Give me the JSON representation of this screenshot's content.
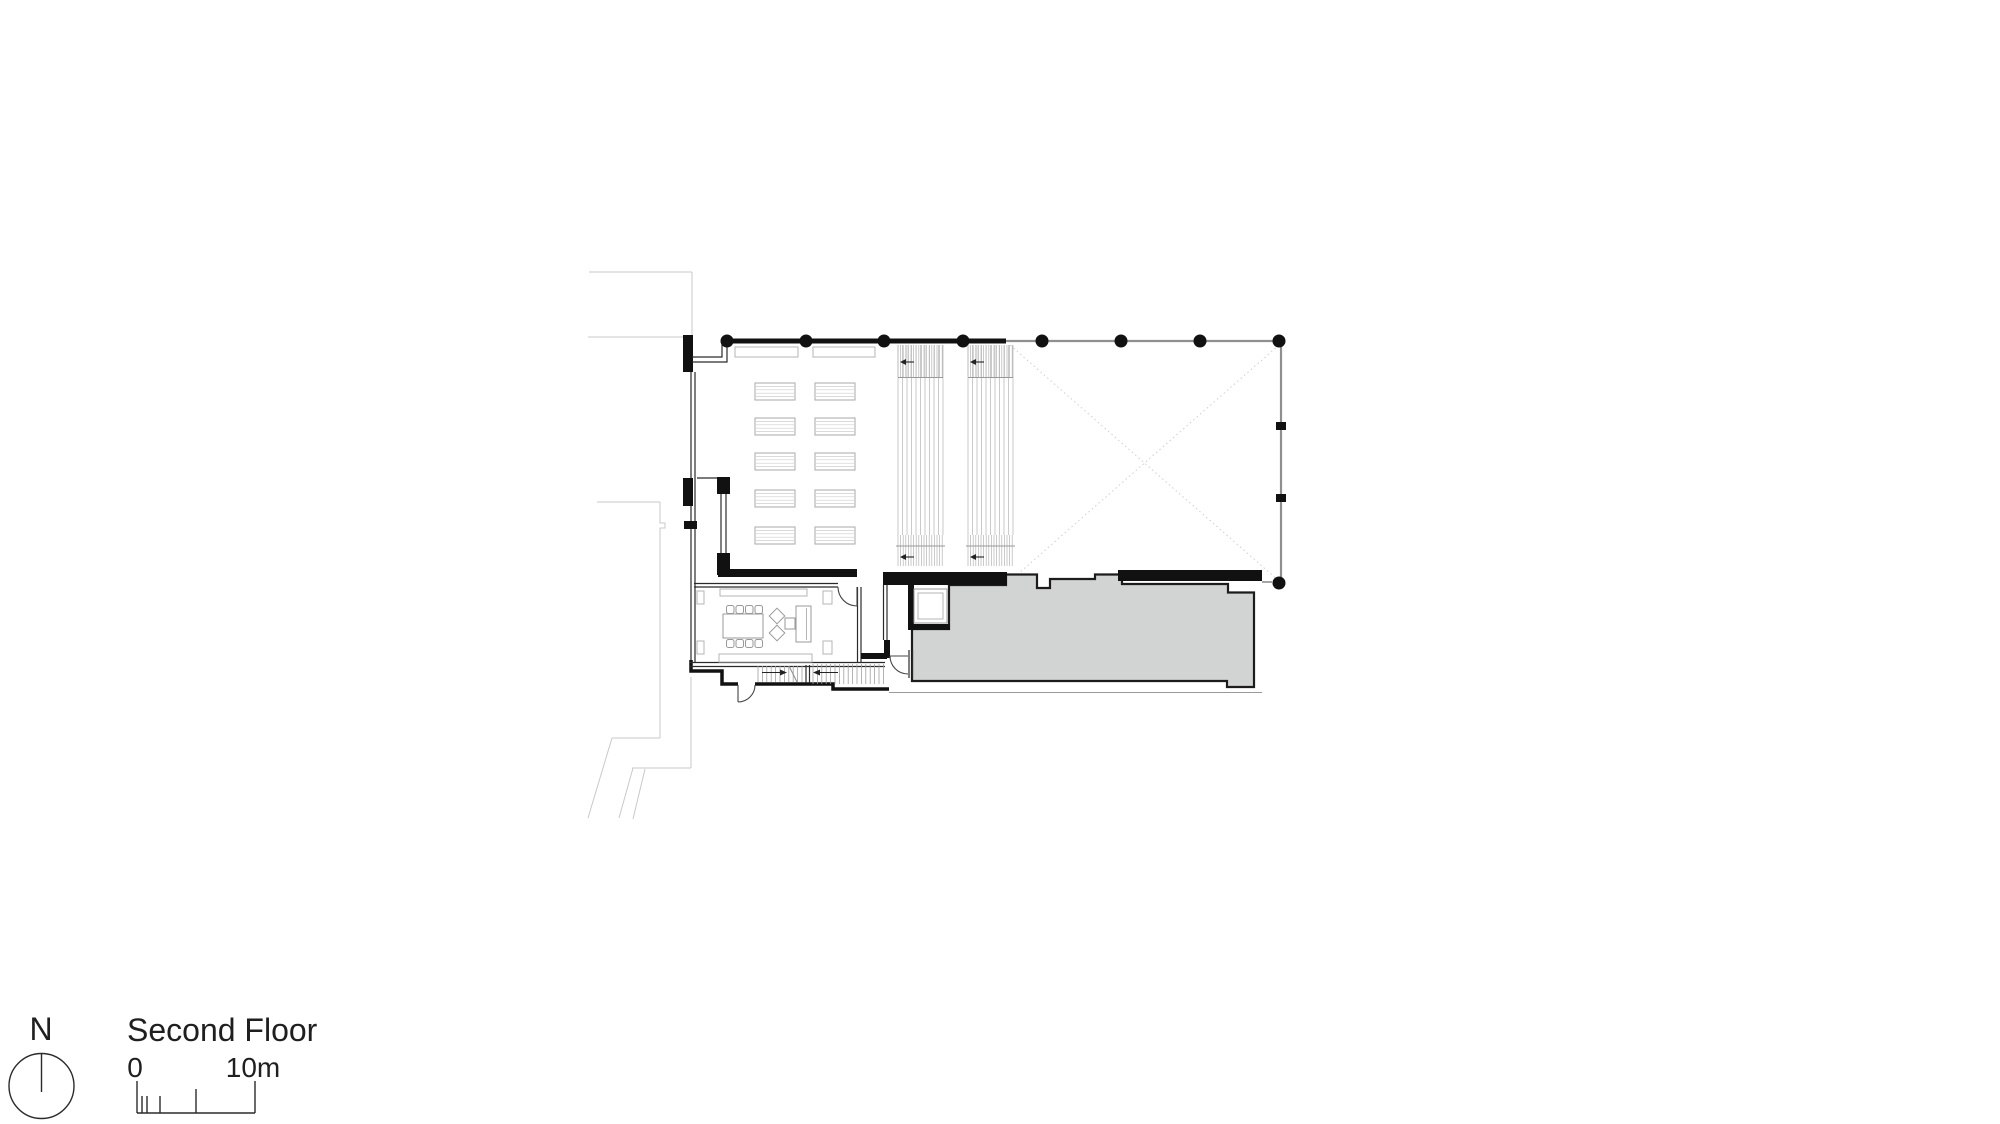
{
  "page": {
    "kind": "architectural floor plan drawing",
    "background": "#ffffff"
  },
  "legend": {
    "north_label": "N",
    "floor_title": "Second Floor",
    "scale_bar": {
      "start_label": "0",
      "end_label": "10m"
    }
  },
  "plan": {
    "structural_column_count": 9,
    "desk_rows": 5,
    "desk_columns": 2,
    "seating_band_count": 2
  },
  "colors": {
    "background": "#ffffff",
    "ink": "#1a1a1a",
    "wall_black": "#111111",
    "medium_gray": "#8f8f8f",
    "light_gray": "#c9c9c9",
    "terrace_fill": "#d2d4d4"
  }
}
